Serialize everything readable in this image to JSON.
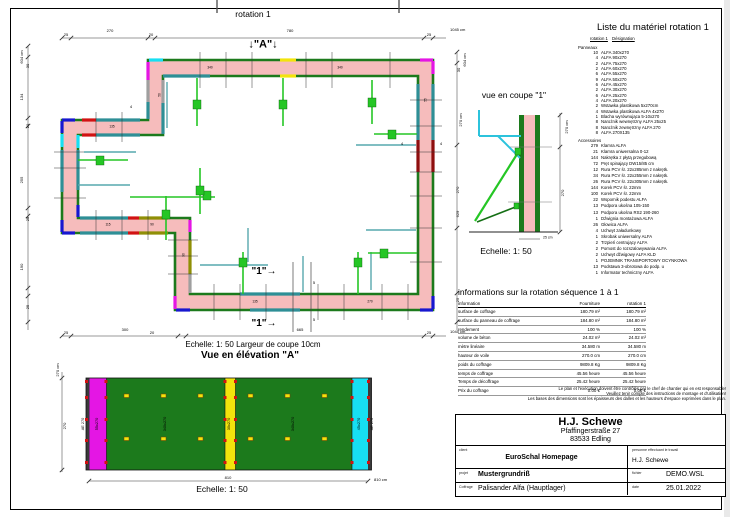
{
  "palette": {
    "pink": "#f6bcbc",
    "green": "#1c7a1c",
    "teal": "#2e8f96",
    "cyan": "#17dff2",
    "mag": "#e416e4",
    "blue": "#1717cf",
    "red": "#d11212",
    "dred": "#8e0e0e",
    "olive": "#8f8f06",
    "grayp": "#9f9f9f",
    "yellow": "#f2e40c",
    "brace": "#25c625",
    "dbrace": "#156f15",
    "tline": "#57a8ae",
    "cyan2": "#2cc3dc"
  },
  "material_list": {
    "title": "Liste du matériel  rotation 1",
    "col_rotation": "rotation 1",
    "col_designation": "Désignation",
    "group_panneaux": "Panneaux",
    "group_accessoires": "Accessoires",
    "panneaux": [
      {
        "q": "10",
        "n": "ALFA 340x270"
      },
      {
        "q": "4",
        "n": "ALFA 90x270"
      },
      {
        "q": "2",
        "n": "ALFA 75x270"
      },
      {
        "q": "2",
        "n": "ALFA 60x270"
      },
      {
        "q": "6",
        "n": "ALFA 55x270"
      },
      {
        "q": "9",
        "n": "ALFA 50x270"
      },
      {
        "q": "6",
        "n": "ALFA 45x270"
      },
      {
        "q": "2",
        "n": "ALFA 30x270"
      },
      {
        "q": "6",
        "n": "ALFA 25x270"
      },
      {
        "q": "4",
        "n": "ALFA 20x270"
      },
      {
        "q": "2",
        "n": "Wstawka plastikowa 5x270cm"
      },
      {
        "q": "4",
        "n": "Wstawka plastikowa ALFA 4x270"
      },
      {
        "q": "1",
        "n": "Blacha wyrównująca 5-10x270"
      },
      {
        "q": "8",
        "n": "Narożnik wewnętrzny ALFA 25x25"
      },
      {
        "q": "8",
        "n": "Narożnik zewnętrzny ALFA 270"
      },
      {
        "q": "8",
        "n": "ALFA 270X135"
      }
    ],
    "accessoires": [
      {
        "q": "279",
        "n": "Klamra ALFA"
      },
      {
        "q": "21",
        "n": "Klamra uniwersalna 0-12"
      },
      {
        "q": "144",
        "n": "Nakrętka z płytą przegubową"
      },
      {
        "q": "72",
        "n": "Pręt spinający DW15/85 cm"
      },
      {
        "q": "12",
        "n": "Rura PCV śr. 22x285mm z nakrętk."
      },
      {
        "q": "34",
        "n": "Rura PCV śr. 22x255mm z nakrętk."
      },
      {
        "q": "26",
        "n": "Rura PCV śr. 22x305mm z nakrętk."
      },
      {
        "q": "144",
        "n": "Korek PCV śr. 22mm"
      },
      {
        "q": "100",
        "n": "Korek PCV śr. 22mm"
      },
      {
        "q": "22",
        "n": "Wspornik podestu ALFA"
      },
      {
        "q": "13",
        "n": "Podpora ukośna 105-150"
      },
      {
        "q": "13",
        "n": "Podpora ukośna RS2 190-260"
      },
      {
        "q": "1",
        "n": "Dźwignia montażowa ALFA"
      },
      {
        "q": "26",
        "n": "Głowica ALFA"
      },
      {
        "q": "4",
        "n": "Uchwyt załadunkowy"
      },
      {
        "q": "1",
        "n": "Skrobak uniwersalny ALFA"
      },
      {
        "q": "2",
        "n": "Trzpień centrujący ALFA"
      },
      {
        "q": "2",
        "n": "Pomost do rozszalowywania ALFA"
      },
      {
        "q": "2",
        "n": "Uchwyt dźwigowy ALFA KLD"
      },
      {
        "q": "1",
        "n": "POJEMNIK TRANSPORTOWY OCYNKOWA"
      },
      {
        "q": "13",
        "n": "Podstawa 3-obrotowa do podp. u"
      },
      {
        "q": "1",
        "n": "Informator techniczny ALFA"
      }
    ]
  },
  "info_table": {
    "title": "informations sur la rotation  séquence 1 à 1",
    "col_info": "information",
    "col_fourniture": "Fourniture",
    "col_rotation": "rotation 1",
    "rows": [
      {
        "l": "surface de coffrage",
        "f": "180.79 m²",
        "r": "180.79 m²"
      },
      {
        "l": "surface du panneau de coffrage",
        "f": "184.80 m²",
        "r": "184.80 m²"
      },
      {
        "l": "rendement",
        "f": "100 %",
        "r": "100 %"
      },
      {
        "l": "volume de béton",
        "f": "24.02 m³",
        "r": "24.02 m³"
      },
      {
        "l": "mètre linéaire",
        "f": "34.580 m",
        "r": "34.580 m"
      },
      {
        "l": "hauteur de voile",
        "f": "270.0 cm",
        "r": "270.0 cm"
      },
      {
        "l": "poids du coffrage",
        "f": "9809.8 Kg",
        "r": "9809.8 Kg"
      },
      {
        "l": "temps de coffrage",
        "f": "45.56 heure",
        "r": "45.56 heure"
      },
      {
        "l": "Temps de décoffrage",
        "f": "25.42 heure",
        "r": "25.42 heure"
      },
      {
        "l": "Prix du coffrage",
        "f": "0.00 €",
        "r": "0.00 €"
      }
    ]
  },
  "notes": [
    "Le plan et l'exécution doivent être contrôlés par le chef de chantier qui en est responsable!",
    "Veuillez tenir compte des instructions de montage et d'utilisation!",
    "Les bases des dimensions sont les épaisseurs des dalles et les hauteurs d'espace exprimées dans le plan."
  ],
  "title_block": {
    "company": "H.J. Schewe",
    "address1": "Pfaffingerstraße 27",
    "address2": "83533 Edling",
    "client_label": "client",
    "client": "EuroSchal Homepage",
    "person_label": "personne effectuant le travail",
    "person": "H.J. Schewe",
    "project_label": "projet",
    "project": "Mustergrundriß",
    "file_label": "fichier",
    "file": "DEMO.WSL",
    "coffrage_label": "Coffrage",
    "coffrage": "Palisander Alfa (Hauptlager)",
    "date_label": "date",
    "date": "25.01.2022"
  },
  "labels": [
    {
      "t": "rotation 1",
      "x": 253,
      "y": 14,
      "s": 8.5
    },
    {
      "t": "↓\"A\"↓",
      "x": 263,
      "y": 45,
      "s": 11,
      "b": 1
    },
    {
      "t": "25",
      "x": 66,
      "y": 35,
      "s": 4
    },
    {
      "t": "270",
      "x": 110,
      "y": 31,
      "s": 4
    },
    {
      "t": "20",
      "x": 151,
      "y": 35,
      "s": 4
    },
    {
      "t": "780",
      "x": 290,
      "y": 31,
      "s": 4
    },
    {
      "t": "25",
      "x": 429,
      "y": 35,
      "s": 4
    },
    {
      "t": "1045 cm",
      "x": 450,
      "y": 30,
      "s": 4,
      "a": "l"
    },
    {
      "t": "604 cm",
      "x": 22,
      "y": 57,
      "s": 4,
      "r": -90
    },
    {
      "t": "30",
      "x": 28,
      "y": 66,
      "s": 4,
      "r": -90
    },
    {
      "t": "134",
      "x": 22,
      "y": 97,
      "s": 4,
      "r": -90
    },
    {
      "t": "20",
      "x": 28,
      "y": 126,
      "s": 4,
      "r": -90
    },
    {
      "t": "255",
      "x": 22,
      "y": 180,
      "s": 4,
      "r": -90
    },
    {
      "t": "25",
      "x": 28,
      "y": 219,
      "s": 4,
      "r": -90
    },
    {
      "t": "190",
      "x": 22,
      "y": 267,
      "s": 4,
      "r": -90
    },
    {
      "t": "25",
      "x": 28,
      "y": 307,
      "s": 4,
      "r": -90
    },
    {
      "t": "25",
      "x": 66,
      "y": 333,
      "s": 4
    },
    {
      "t": "300",
      "x": 125,
      "y": 330,
      "s": 4
    },
    {
      "t": "20",
      "x": 152,
      "y": 333,
      "s": 4
    },
    {
      "t": "665",
      "x": 300,
      "y": 330,
      "s": 4
    },
    {
      "t": "25",
      "x": 429,
      "y": 333,
      "s": 4
    },
    {
      "t": "1045 cm",
      "x": 450,
      "y": 332,
      "s": 4,
      "a": "l"
    },
    {
      "t": "604 cm",
      "x": 465,
      "y": 60,
      "s": 4,
      "r": -90
    },
    {
      "t": "30",
      "x": 459,
      "y": 70,
      "s": 4,
      "r": -90
    },
    {
      "t": "270 cm",
      "x": 461,
      "y": 120,
      "s": 4,
      "r": -90
    },
    {
      "t": "270",
      "x": 458,
      "y": 190,
      "s": 4,
      "r": -90
    },
    {
      "t": "629",
      "x": 458,
      "y": 214,
      "s": 4,
      "r": -90
    },
    {
      "t": "25",
      "x": 458,
      "y": 300,
      "s": 4,
      "r": -90
    },
    {
      "t": "4",
      "x": 131,
      "y": 107,
      "s": 4
    },
    {
      "t": "4",
      "x": 402,
      "y": 144,
      "s": 4
    },
    {
      "t": "4",
      "x": 441,
      "y": 144,
      "s": 4
    },
    {
      "t": "\"1\"→",
      "x": 264,
      "y": 272,
      "s": 10,
      "b": 1
    },
    {
      "t": "\"1\"→",
      "x": 264,
      "y": 324,
      "s": 10,
      "b": 1
    },
    {
      "t": "5",
      "x": 314,
      "y": 283,
      "s": 4
    },
    {
      "t": "5",
      "x": 314,
      "y": 320,
      "s": 4
    },
    {
      "t": "Echelle: 1: 50   Largeur de coupe 10cm",
      "x": 253,
      "y": 345,
      "s": 8
    },
    {
      "t": "Vue en élévation \"A\"",
      "x": 250,
      "y": 356,
      "s": 10,
      "b": 1
    },
    {
      "t": "vue en coupe \"1\"",
      "x": 514,
      "y": 95,
      "s": 8.5
    },
    {
      "t": "270 cm",
      "x": 567,
      "y": 127,
      "s": 4,
      "r": -90
    },
    {
      "t": "270",
      "x": 563,
      "y": 193,
      "s": 4,
      "r": -90
    },
    {
      "t": "25 cm",
      "x": 543,
      "y": 238,
      "s": 3.5,
      "a": "l"
    },
    {
      "t": "Echelle: 1: 50",
      "x": 506,
      "y": 251,
      "s": 8.5
    },
    {
      "t": "270 cm",
      "x": 58,
      "y": 370,
      "s": 4,
      "r": -90
    },
    {
      "t": "270",
      "x": 65,
      "y": 426,
      "s": 4,
      "r": -90
    },
    {
      "t": "AE 270",
      "x": 84,
      "y": 424,
      "s": 3.8,
      "r": -90
    },
    {
      "t": "55x270",
      "x": 98,
      "y": 424,
      "s": 3.8,
      "r": -90
    },
    {
      "t": "340x270",
      "x": 166,
      "y": 424,
      "s": 3.8,
      "r": -90
    },
    {
      "t": "30x270",
      "x": 230,
      "y": 424,
      "s": 3.8,
      "r": -90
    },
    {
      "t": "340x270",
      "x": 294,
      "y": 424,
      "s": 3.8,
      "r": -90
    },
    {
      "t": "45x270",
      "x": 360,
      "y": 424,
      "s": 3.8,
      "r": -90
    },
    {
      "t": "AE 270",
      "x": 373,
      "y": 424,
      "s": 3.8,
      "r": -90
    },
    {
      "t": "810",
      "x": 228,
      "y": 478,
      "s": 4
    },
    {
      "t": "810 cm",
      "x": 374,
      "y": 480,
      "s": 4,
      "a": "l"
    },
    {
      "t": "Echelle: 1: 50",
      "x": 222,
      "y": 489,
      "s": 8.5
    },
    {
      "t": "340",
      "x": 210,
      "y": 68,
      "s": 3.2
    },
    {
      "t": "340",
      "x": 340,
      "y": 68,
      "s": 3.2
    },
    {
      "t": "135",
      "x": 112,
      "y": 127,
      "s": 3.2
    },
    {
      "t": "115",
      "x": 108,
      "y": 225,
      "s": 3.2
    },
    {
      "t": "90",
      "x": 152,
      "y": 225,
      "s": 3.2
    },
    {
      "t": "90",
      "x": 184,
      "y": 255,
      "s": 3.2,
      "r": -90
    },
    {
      "t": "135",
      "x": 255,
      "y": 302,
      "s": 3.2
    },
    {
      "t": "270",
      "x": 370,
      "y": 302,
      "s": 3.2
    },
    {
      "t": "55",
      "x": 426,
      "y": 100,
      "s": 3.2,
      "r": -90
    },
    {
      "t": "50",
      "x": 160,
      "y": 95,
      "s": 3.2,
      "r": -90
    }
  ]
}
